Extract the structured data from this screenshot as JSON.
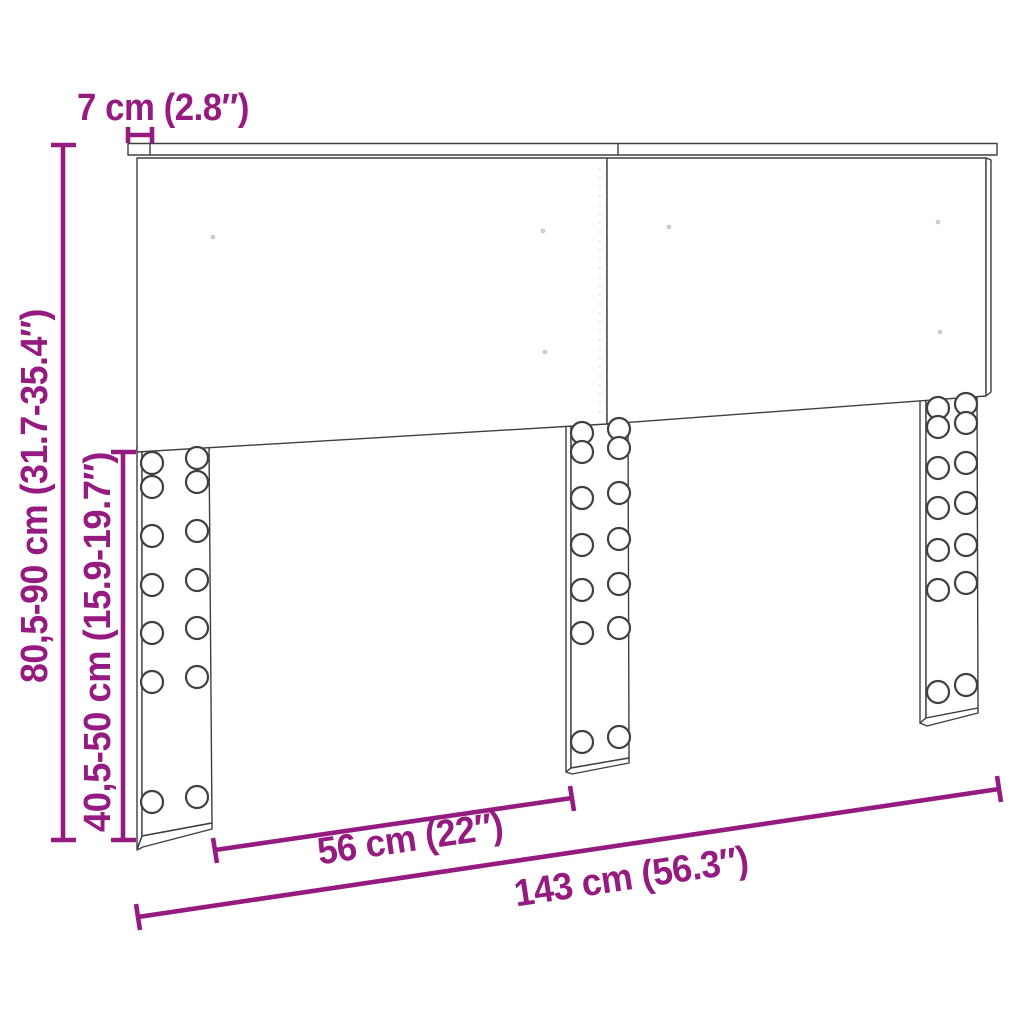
{
  "figure": {
    "kind": "product-dimension-diagram",
    "colors": {
      "accent": "#951b81",
      "outline": "#3f3f3f",
      "background": "#ffffff"
    },
    "dims": {
      "rail_depth": "7 cm (2.8″)",
      "overall_height": "80,5-90 cm (31.7-35.4″)",
      "leg_height": "40,5-50 cm (15.9-19.7″)",
      "inner_leg_spacing": "56 cm (22″)",
      "overall_width": "143 cm (56.3″)"
    }
  }
}
